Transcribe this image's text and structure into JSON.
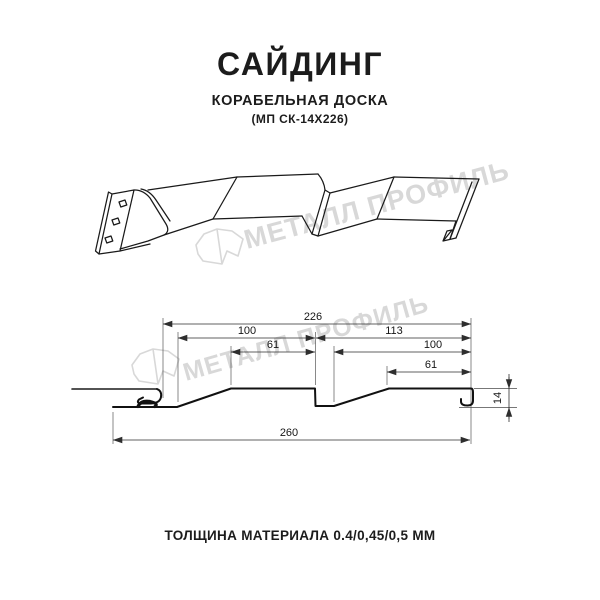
{
  "header": {
    "title": "САЙДИНГ",
    "subtitle": "КОРАБЕЛЬНАЯ ДОСКА",
    "model": "(МП СК-14Х226)"
  },
  "watermark": {
    "text": "МЕТАЛЛ ПРОФИЛЬ",
    "color": "#d8d8d8"
  },
  "section": {
    "dimensions": {
      "overall_top": "226",
      "left_upper": "100",
      "right_upper": "113",
      "left_inner": "61",
      "right_inner": "100",
      "right_small": "61",
      "overall_bottom": "260",
      "height": "14"
    }
  },
  "footer": {
    "thickness": "ТОЛЩИНА МАТЕРИАЛА 0.4/0,45/0,5 ММ"
  },
  "colors": {
    "line": "#1a1a1a",
    "dimension": "#2e2e2e",
    "watermark": "#d8d8d8",
    "background": "#ffffff"
  }
}
